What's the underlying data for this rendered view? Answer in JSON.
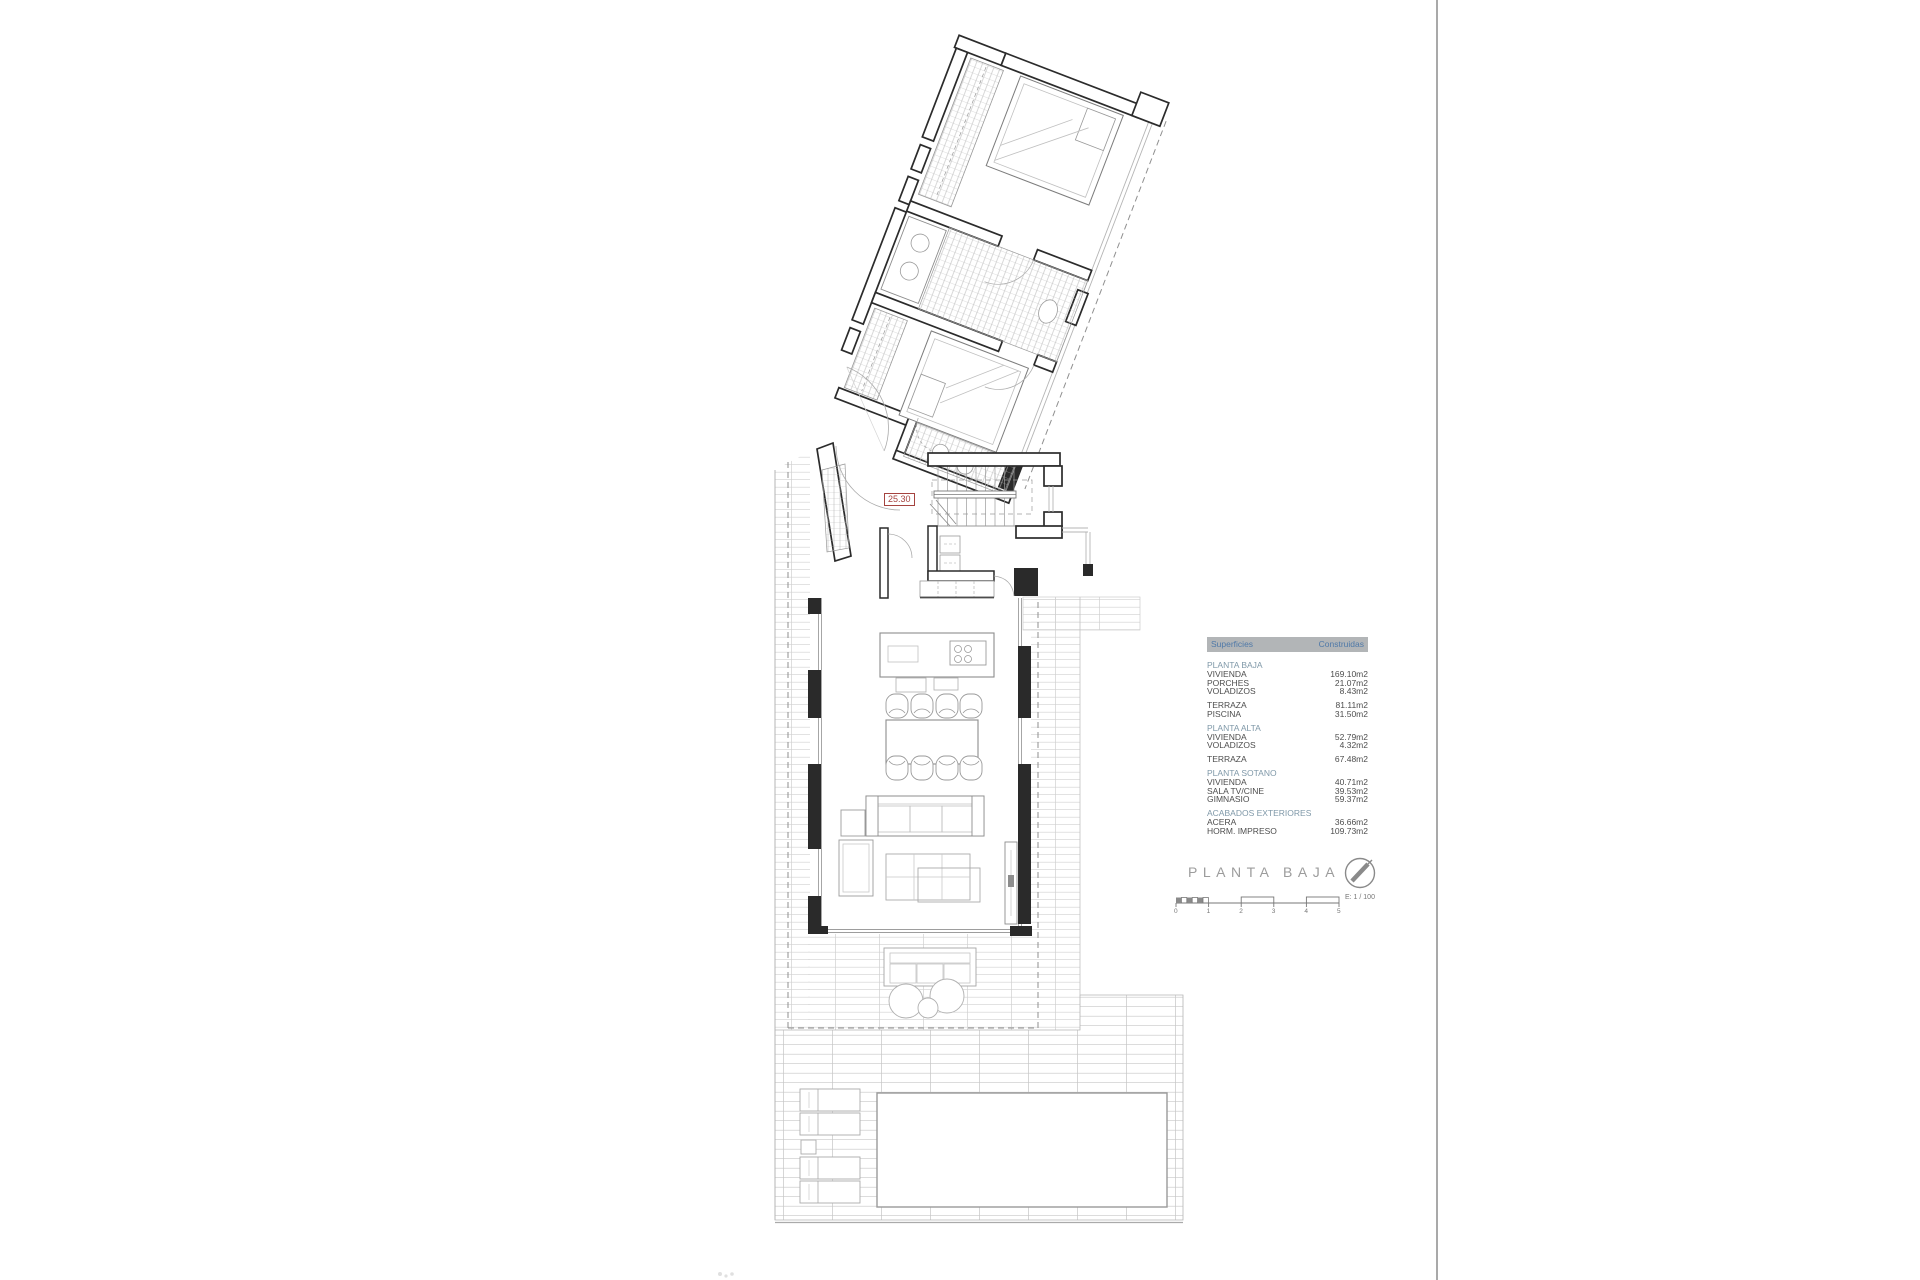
{
  "title": "PLANTA BAJA",
  "plan": {
    "dimension_label": "25.30"
  },
  "scale": {
    "ticks": [
      "0",
      "1",
      "2",
      "3",
      "4",
      "5"
    ],
    "label": "E: 1 / 100"
  },
  "colors": {
    "header_bg": "#b2b5b7",
    "header_text": "#4f79a8",
    "section_text": "#7f98a8",
    "dimension_red": "#a5433f",
    "wall_line": "#2b2b2b"
  },
  "areas_table": {
    "header": {
      "col1": "Superficies",
      "col2": "Construidas"
    },
    "groups": [
      {
        "section": "PLANTA BAJA",
        "rows": [
          {
            "label": "VIVIENDA",
            "value": "169.10m2"
          },
          {
            "label": "PORCHES",
            "value": "21.07m2"
          },
          {
            "label": "VOLADIZOS",
            "value": "8.43m2"
          }
        ]
      },
      {
        "section": "",
        "rows": [
          {
            "label": "TERRAZA",
            "value": "81.11m2"
          },
          {
            "label": "PISCINA",
            "value": "31.50m2"
          }
        ]
      },
      {
        "section": "PLANTA ALTA",
        "rows": [
          {
            "label": "VIVIENDA",
            "value": "52.79m2"
          },
          {
            "label": "VOLADIZOS",
            "value": "4.32m2"
          }
        ]
      },
      {
        "section": "",
        "rows": [
          {
            "label": "TERRAZA",
            "value": "67.48m2"
          }
        ]
      },
      {
        "section": "PLANTA SOTANO",
        "rows": [
          {
            "label": "VIVIENDA",
            "value": "40.71m2"
          },
          {
            "label": "SALA TV/CINE",
            "value": "39.53m2"
          },
          {
            "label": "GIMNASIO",
            "value": "59.37m2"
          }
        ]
      },
      {
        "section": "ACABADOS EXTERIORES",
        "rows": [
          {
            "label": "ACERA",
            "value": "36.66m2"
          },
          {
            "label": "HORM. IMPRESO",
            "value": "109.73m2"
          }
        ]
      }
    ]
  }
}
